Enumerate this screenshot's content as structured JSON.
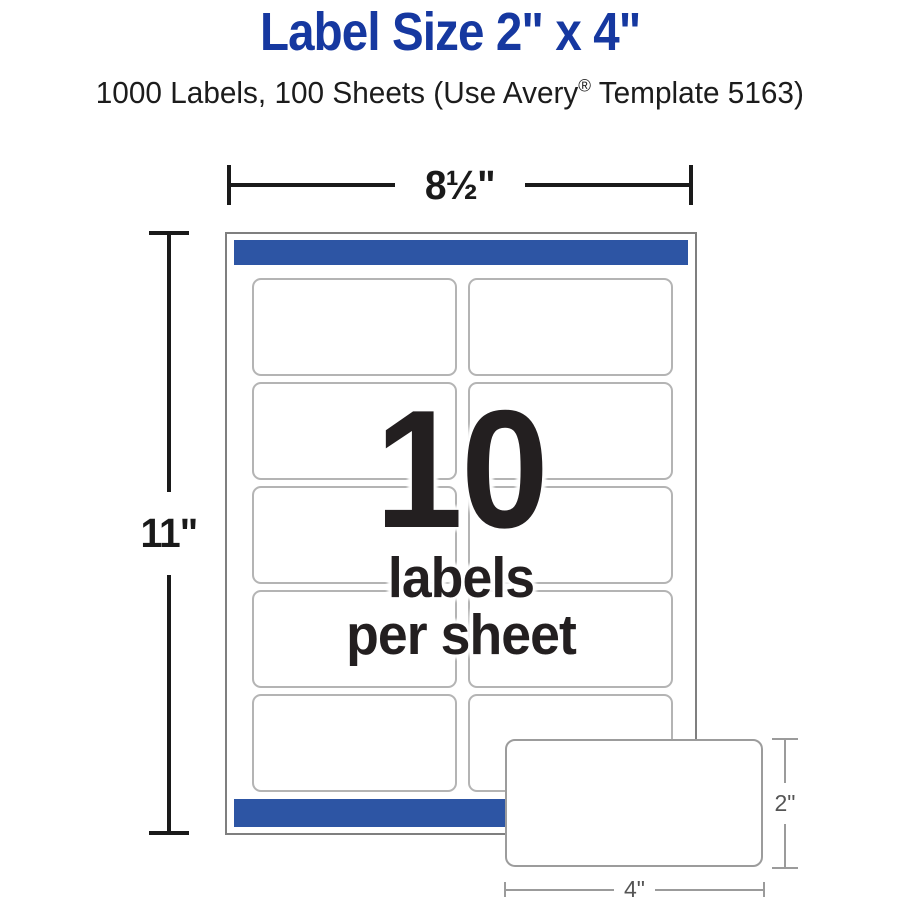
{
  "header": {
    "title": "Label Size 2\" x 4\"",
    "subtitle_pre": "1000 Labels, 100 Sheets (Use Avery",
    "subtitle_reg": "®",
    "subtitle_post": " Template 5163)"
  },
  "diagram": {
    "sheet_width_label": "8½\"",
    "sheet_height_label": "11\"",
    "grid": {
      "rows": 5,
      "cols": 2
    },
    "center": {
      "count": "10",
      "line1": "labels",
      "line2": "per sheet"
    },
    "callout": {
      "height_label": "2\"",
      "width_label": "4\""
    }
  },
  "colors": {
    "title_blue": "#1638a0",
    "bar_blue": "#2d55a4",
    "dim_black": "#1a1a1a",
    "sheet_border": "#7f7f7f",
    "label_border": "#b4b4b4",
    "dim_gray": "#9b9b9b",
    "dim_gray_text": "#555555"
  }
}
